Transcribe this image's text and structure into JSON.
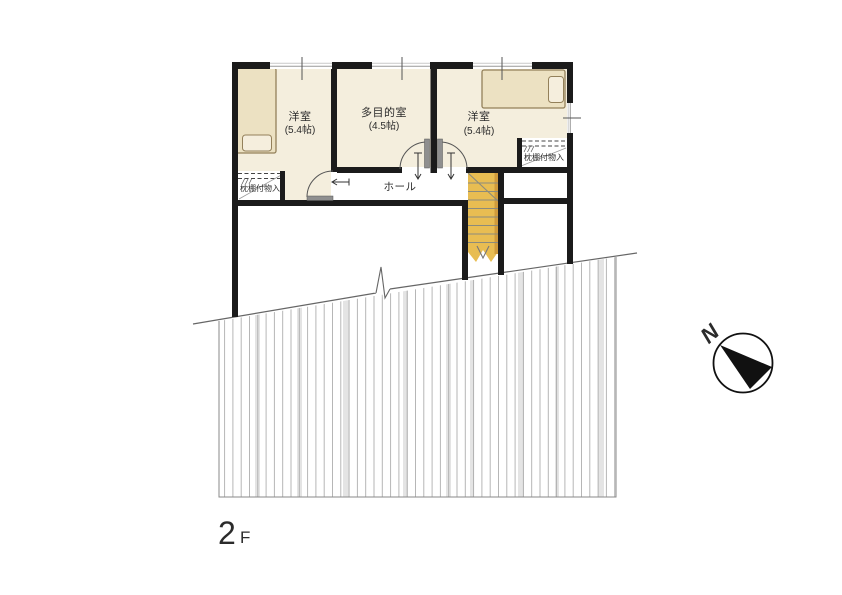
{
  "floorplan": {
    "floor_label": {
      "number": "2",
      "suffix": "F"
    },
    "compass_label": "N",
    "rooms": {
      "left": {
        "name": "洋室",
        "size": "(5.4帖)"
      },
      "middle": {
        "name": "多目的室",
        "size": "(4.5帖)"
      },
      "right": {
        "name": "洋室",
        "size": "(5.4帖)"
      }
    },
    "hall_label": "ホール",
    "closet_left_label": "枕棚付物入",
    "closet_right_label": "枕棚付物入",
    "colors": {
      "wall": "#1b1b1b",
      "floor_fill": "#f4eedd",
      "bed_fill": "#ece1c2",
      "pillow_fill": "#f5eedd",
      "stair_fill": "#e8bd52",
      "stair_edge": "#d09b3c",
      "hatch_line": "#a3a3a3"
    }
  }
}
